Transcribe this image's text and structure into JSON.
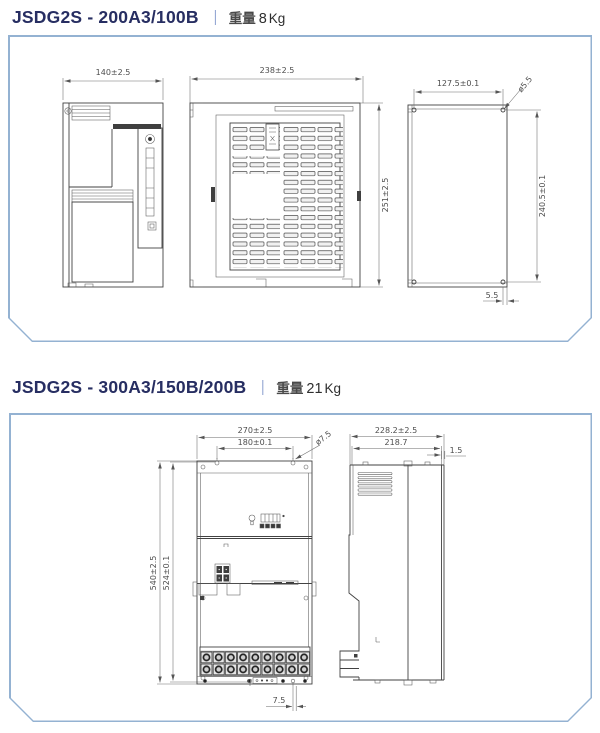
{
  "colors": {
    "model_text": "#272e62",
    "separator": "#4767b2",
    "weight_text": "#4a4a4a",
    "panel_border": "#94b2d2",
    "drawing_line": "#424242",
    "dim_text": "#4d4d4d"
  },
  "sections": [
    {
      "model": "JSDG2S - 200A3/100B",
      "separator": "｜",
      "weight_label": "重量",
      "weight_value": "8",
      "weight_unit": "Kg",
      "views": [
        {
          "label": "side-view",
          "dims": {
            "width": "140±2.5"
          }
        },
        {
          "label": "front-view",
          "dims": {
            "width": "238±2.5",
            "height": "251±2.5"
          }
        },
        {
          "label": "mounting-plate-view",
          "dims": {
            "hole_pitch_width": "127.5±0.1",
            "hole_diameter": "ø5.5",
            "hole_pitch_height": "240.5±0.1",
            "hole_edge_offset": "5.5"
          }
        }
      ]
    },
    {
      "model": "JSDG2S - 300A3/150B/200B",
      "separator": "｜",
      "weight_label": "重量",
      "weight_value": "21",
      "weight_unit": "Kg",
      "views": [
        {
          "label": "front-view",
          "dims": {
            "width": "270±2.5",
            "hole_pitch_width": "180±0.1",
            "hole_diameter": "ø7.5",
            "height": "540±2.5",
            "hole_pitch_height": "524±0.1",
            "hole_bottom_offset": "7.5"
          }
        },
        {
          "label": "side-view",
          "dims": {
            "depth": "228.2±2.5",
            "inner_depth": "218.7",
            "flange_lip": "1.5"
          }
        }
      ]
    }
  ]
}
